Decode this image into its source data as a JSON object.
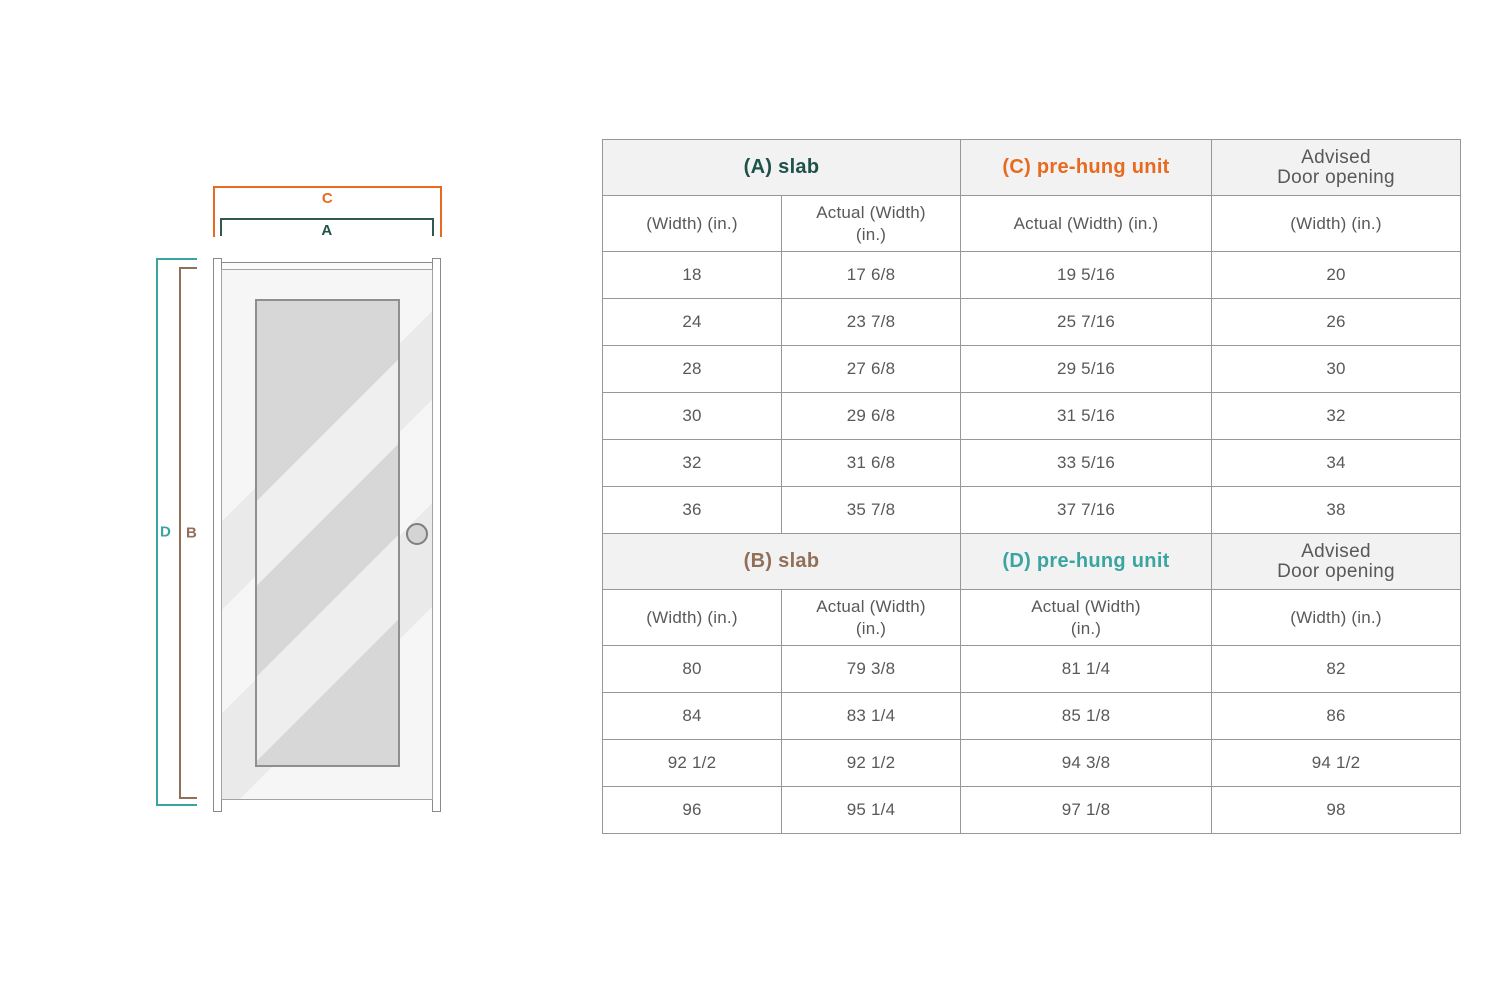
{
  "diagram": {
    "labels": {
      "a": "A",
      "b": "B",
      "c": "C",
      "d": "D"
    },
    "colors": {
      "a_slab_width": "#1E5148",
      "b_slab_height": "#926F58",
      "c_prehung_width": "#E76A1F",
      "d_prehung_height": "#3AA5A0",
      "a_line": "#31574E"
    }
  },
  "table": {
    "sections": [
      {
        "group_headers": [
          {
            "label": "(A) slab",
            "color": "#1E5148"
          },
          {
            "label": "(C) pre-hung unit",
            "color": "#E76A1F"
          },
          {
            "label": [
              "Advised",
              "Door opening"
            ],
            "color": "#58595B"
          }
        ],
        "column_headers": [
          [
            "(Width) (in.)"
          ],
          [
            "Actual (Width)",
            "(in.)"
          ],
          [
            "Actual (Width) (in.)"
          ],
          [
            "(Width) (in.)"
          ]
        ],
        "rows": [
          [
            "18",
            "17 6/8",
            "19 5/16",
            "20"
          ],
          [
            "24",
            "23 7/8",
            "25 7/16",
            "26"
          ],
          [
            "28",
            "27 6/8",
            "29 5/16",
            "30"
          ],
          [
            "30",
            "29 6/8",
            "31 5/16",
            "32"
          ],
          [
            "32",
            "31 6/8",
            "33 5/16",
            "34"
          ],
          [
            "36",
            "35 7/8",
            "37 7/16",
            "38"
          ]
        ]
      },
      {
        "group_headers": [
          {
            "label": "(B) slab",
            "color": "#926F58"
          },
          {
            "label": "(D) pre-hung unit",
            "color": "#3AA5A0"
          },
          {
            "label": [
              "Advised",
              "Door opening"
            ],
            "color": "#58595B"
          }
        ],
        "column_headers": [
          [
            "(Width) (in.)"
          ],
          [
            "Actual (Width)",
            "(in.)"
          ],
          [
            "Actual (Width)",
            "(in.)"
          ],
          [
            "(Width) (in.)"
          ]
        ],
        "rows": [
          [
            "80",
            "79 3/8",
            "81 1/4",
            "82"
          ],
          [
            "84",
            "83 1/4",
            "85 1/8",
            "86"
          ],
          [
            "92 1/2",
            "92 1/2",
            "94 3/8",
            "94 1/2"
          ],
          [
            "96",
            "95 1/4",
            "97 1/8",
            "98"
          ]
        ]
      }
    ]
  }
}
